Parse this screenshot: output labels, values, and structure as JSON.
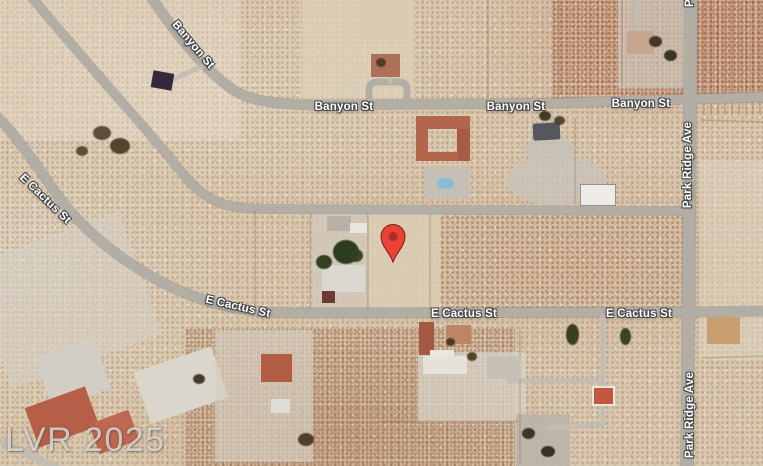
{
  "map": {
    "view": "satellite",
    "watermark": "LVR 2025",
    "streets": [
      "Banyon St",
      "E Cactus St",
      "Park Ridge Ave"
    ],
    "marker": {
      "label": "property-location-pin",
      "x": 393,
      "y": 237,
      "color": "#EA4335",
      "inner_color": "#A93226",
      "outline": "#7A1F14"
    },
    "road_labels": [
      {
        "id": "banyon-st-diagonal",
        "text": "Banyon St",
        "x": 193,
        "y": 45,
        "rotate": 50
      },
      {
        "id": "banyon-st-center",
        "text": "Banyon St",
        "x": 344,
        "y": 107,
        "rotate": 0
      },
      {
        "id": "banyon-st-center-right",
        "text": "Banyon St",
        "x": 516,
        "y": 107,
        "rotate": 0
      },
      {
        "id": "banyon-st-right",
        "text": "Banyon St",
        "x": 641,
        "y": 104,
        "rotate": 0
      },
      {
        "id": "e-cactus-st-diagonal",
        "text": "E Cactus St",
        "x": 45,
        "y": 199,
        "rotate": 44
      },
      {
        "id": "e-cactus-st-left",
        "text": "E Cactus St",
        "x": 238,
        "y": 307,
        "rotate": 13
      },
      {
        "id": "e-cactus-st-center",
        "text": "E Cactus St",
        "x": 464,
        "y": 314,
        "rotate": 0
      },
      {
        "id": "e-cactus-st-right",
        "text": "E Cactus St",
        "x": 639,
        "y": 314,
        "rotate": 0
      },
      {
        "id": "park-ridge-ave-top-partial",
        "text": "P",
        "x": 690,
        "y": 3,
        "rotate": -90
      },
      {
        "id": "park-ridge-ave-upper",
        "text": "Park Ridge Ave",
        "x": 688,
        "y": 165,
        "rotate": -90
      },
      {
        "id": "park-ridge-ave-lower",
        "text": "Park Ridge Ave",
        "x": 690,
        "y": 415,
        "rotate": -90
      }
    ],
    "colors": {
      "desert_base": "#D8C8AF",
      "road": "#B2AEA6",
      "label_text": "#FFFFFF",
      "watermark_text": "#E4E1DC"
    }
  }
}
